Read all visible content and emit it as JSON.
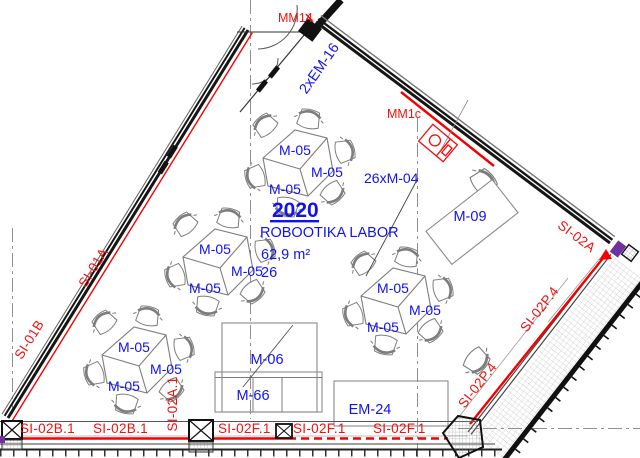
{
  "drawing_title": "floor plan – robotics lab 2020",
  "room_stamp": {
    "number": "2020",
    "name": "ROBOOTIKA LABOR",
    "area": "62,9 m²",
    "capacity": "26"
  },
  "furniture": {
    "table_label": "M-05",
    "desk_label": "M-09",
    "cabinet_label": "M-06",
    "cabinet_low_label": "M-66",
    "equipment_label": "EM-24",
    "chairs_count_label": "26xM-04",
    "door_label": "2xEM-16"
  },
  "markers": {
    "mm14": "MM14",
    "mm1c": "MM1c"
  },
  "wall_labels": {
    "si01a": "SI-01A",
    "si01b": "SI-01B",
    "si02a": "SI-02A",
    "si02p4": "SI-02P.4",
    "si02a1": "SI-02A.1",
    "si02b1": "SI-02B.1",
    "si02f1": "SI-02F.1"
  },
  "colors": {
    "label_blue": "#1212ee",
    "label_red": "#f21010",
    "wall_dark": "#161616",
    "wall_red_line": "#f50000",
    "furniture_gray": "#7d7d7d",
    "grid_gray": "#8f8f8f",
    "accent_purple": "#7030a0",
    "background": "#ffffff"
  }
}
